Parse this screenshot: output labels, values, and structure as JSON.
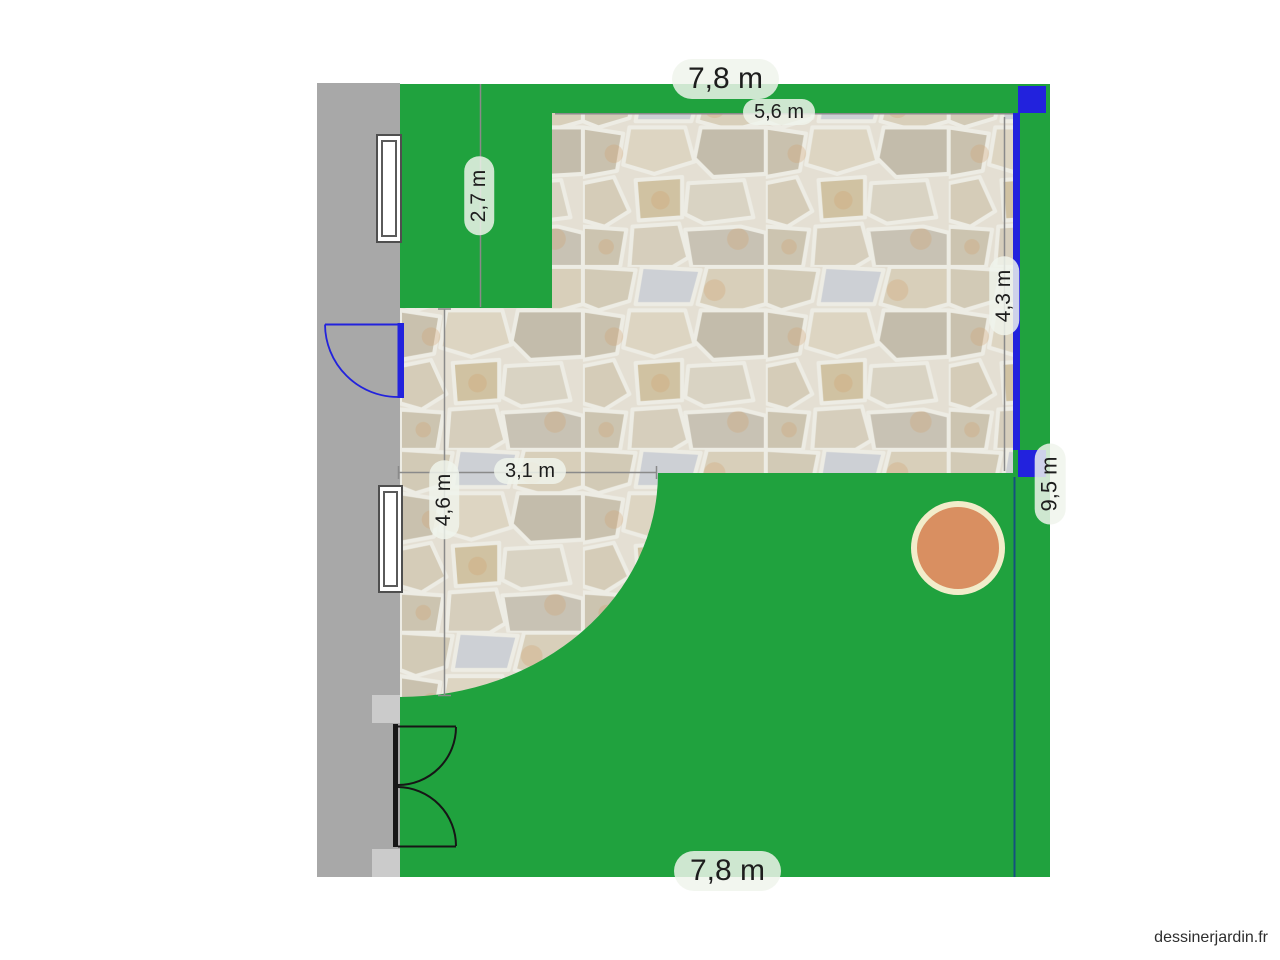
{
  "watermark": "dessinerjardin.fr",
  "dimensions": {
    "garden_top_width": "7,8 m",
    "terrace_top_width": "5,6 m",
    "lawn_corner_height": "2,7 m",
    "terrace_left_height": "4,6 m",
    "terrace_bottom_width": "3,1 m",
    "terrace_right_height": "4,3 m",
    "garden_right_height": "9,5 m",
    "garden_bottom_width": "7,8 m"
  },
  "colors": {
    "lawn_green": "#20a23e",
    "wall_gray": "#a8a8a8",
    "wall_pillar_gray": "#cbcbcb",
    "gate_blue": "#2222dd",
    "door_black": "#161616",
    "dimension_gray": "#8a8a8a",
    "boundary_blue": "#14527d",
    "tree_fill": "#d98f61",
    "tree_ring": "#f2ecca",
    "label_background": "#f0f4ec",
    "label_text": "#1d1d1d",
    "stone_beige": "#d6cdbb",
    "stone_mortar": "#e4dfd3"
  }
}
